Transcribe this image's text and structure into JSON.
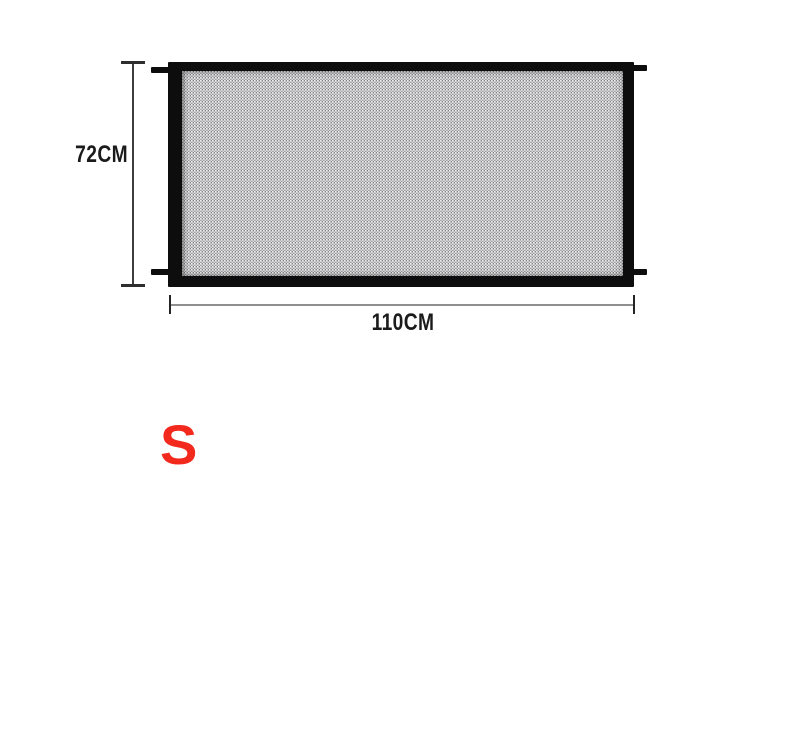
{
  "diagram": {
    "title": "mesh-gate-dimension-diagram",
    "height_label": "72CM",
    "width_label": "110CM",
    "size_label": "S",
    "dimensions": {
      "height_cm": 72,
      "width_cm": 110,
      "size_option": "S"
    }
  },
  "colors": {
    "background": "#ffffff",
    "frame_black": "#0d0d0d",
    "mesh_gray": "#98989c",
    "height_line": "#3d3d3d",
    "width_line": "#8f8f8f",
    "label_text": "#1b1b1b",
    "size_label_red": "#f4291d"
  }
}
